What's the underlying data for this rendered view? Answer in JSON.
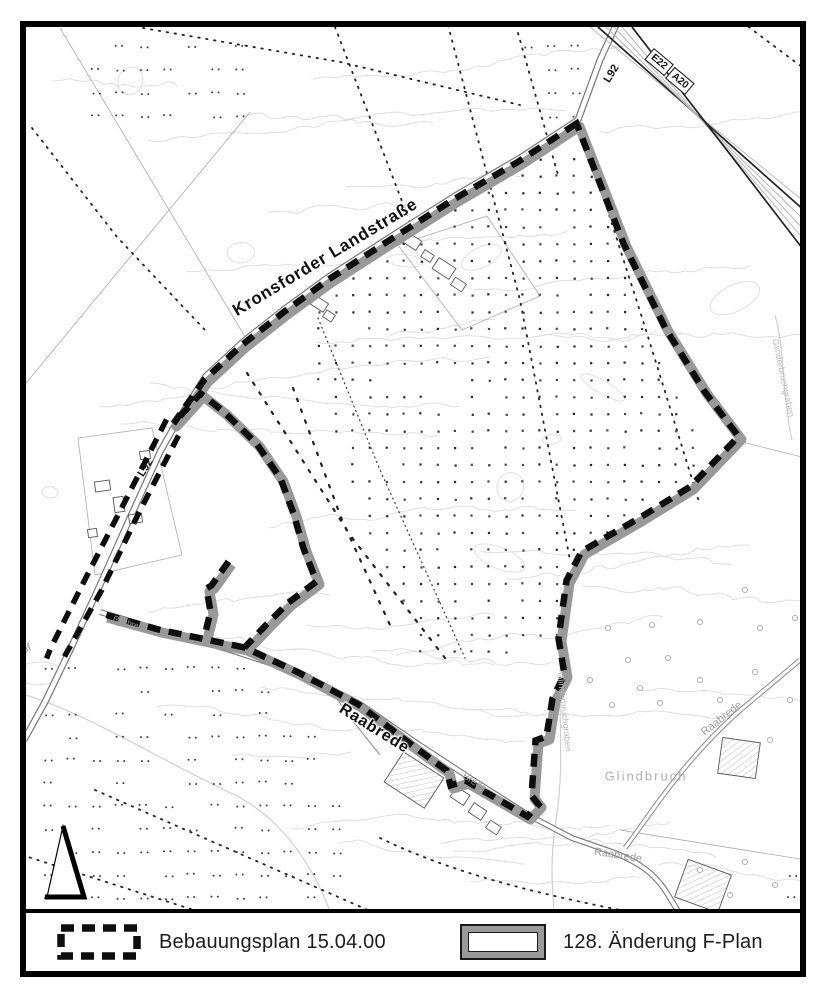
{
  "map": {
    "street_labels": [
      {
        "id": "kronsforder-landstrasse",
        "text": "Kronsforder Landstraße",
        "x": 325,
        "y": 257,
        "rot": -31,
        "size": 17,
        "color": "#111",
        "weight": 700,
        "halo": true,
        "spacing": 0.8
      },
      {
        "id": "raabrede-main",
        "text": "Raabrede",
        "x": 374,
        "y": 729,
        "rot": 32,
        "size": 16,
        "color": "#111",
        "weight": 700,
        "halo": true,
        "spacing": 0.8
      },
      {
        "id": "l92-north",
        "text": "L92",
        "x": 612,
        "y": 74,
        "rot": -58,
        "size": 11,
        "color": "#111",
        "weight": 700
      },
      {
        "id": "l92-west",
        "text": "L92",
        "x": 146,
        "y": 468,
        "rot": -58,
        "size": 11,
        "color": "#111",
        "weight": 700
      },
      {
        "id": "glindbruch",
        "text": "Glindbruch",
        "x": 646,
        "y": 776,
        "rot": 0,
        "size": 13,
        "color": "#b0b0b0",
        "weight": 400,
        "spacing": 2
      },
      {
        "id": "raabrede-ne",
        "text": "Raabrede",
        "x": 722,
        "y": 719,
        "rot": -38,
        "size": 11,
        "color": "#9a9a9a",
        "weight": 400
      },
      {
        "id": "raabrede-south",
        "text": "Raabrede",
        "x": 618,
        "y": 856,
        "rot": 9,
        "size": 11,
        "color": "#9a9a9a",
        "weight": 400
      },
      {
        "id": "glinderbruchgraben-1",
        "text": "Glinderbruchgraben",
        "x": 564,
        "y": 712,
        "rot": 84,
        "size": 9,
        "color": "#bbbbbb",
        "weight": 400
      },
      {
        "id": "glinderbruchgraben-2",
        "text": "Glinderbruchgraben",
        "x": 783,
        "y": 378,
        "rot": 78,
        "size": 9,
        "color": "#bbbbbb",
        "weight": 400
      },
      {
        "id": "hoef-partial",
        "text": "höf",
        "x": 24,
        "y": 651,
        "rot": -25,
        "size": 11,
        "color": "#999999",
        "weight": 400
      },
      {
        "id": "raabrede-small",
        "text": "Raabrede",
        "x": 130,
        "y": 624,
        "rot": 18,
        "size": 8,
        "color": "#999999",
        "weight": 400
      },
      {
        "id": "brede-partial",
        "text": "Brede",
        "x": 474,
        "y": 783,
        "rot": 33,
        "size": 10,
        "color": "#999999",
        "weight": 400
      }
    ],
    "route_signs": [
      {
        "id": "e22",
        "text": "E22",
        "x": 659,
        "y": 62,
        "rot": 40
      },
      {
        "id": "a20",
        "text": "A20",
        "x": 680,
        "y": 81,
        "rot": 40
      }
    ],
    "north_arrow": true
  },
  "legend": {
    "items": [
      {
        "id": "bebauungsplan",
        "label": "Bebauungsplan 15.04.00"
      },
      {
        "id": "fplan-aenderung",
        "label": "128. Änderung F-Plan"
      }
    ]
  },
  "colors": {
    "plan_boundary": "#0d0d0d",
    "fplan_band": "#999999",
    "contour": "#dcdcdc",
    "road": "#777777",
    "minor_text": "#9a9a9a"
  }
}
